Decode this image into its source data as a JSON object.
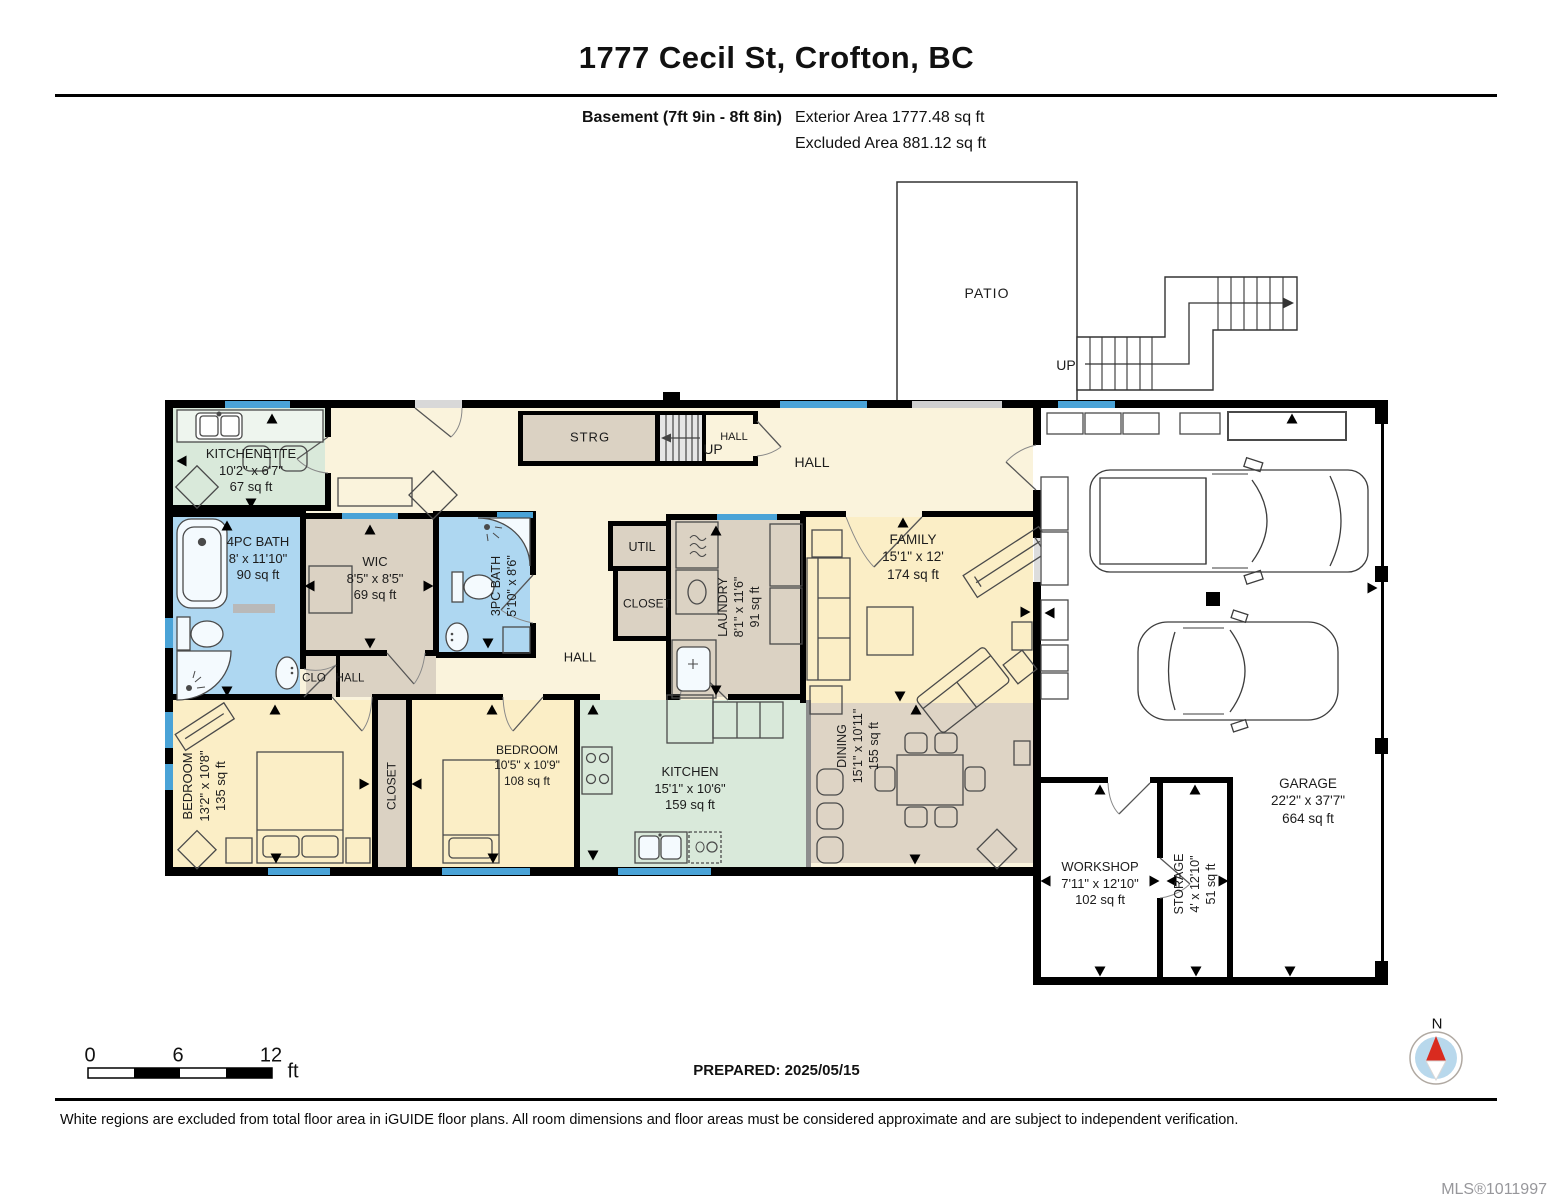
{
  "header": {
    "title": "1777 Cecil St, Crofton, BC",
    "floor_label": "Basement (7ft 9in - 8ft 8in)",
    "exterior_area": "Exterior Area 1777.48 sq ft",
    "excluded_area": "Excluded Area 881.12 sq ft"
  },
  "rooms": {
    "patio": {
      "name": "PATIO"
    },
    "exterior_stairs": {
      "direction": "UP"
    },
    "interior_stairs": {
      "direction": "UP"
    },
    "strg": {
      "name": "STRG"
    },
    "hall_by_stairs": {
      "name": "HALL"
    },
    "hall_top": {
      "name": "HALL"
    },
    "hall_mid": {
      "name": "HALL"
    },
    "clo": {
      "name": "CLO"
    },
    "hall_lower": {
      "name": "HALL"
    },
    "kitchenette": {
      "name": "KITCHENETTE",
      "dims": "10'2\" x 6'7\"",
      "area": "67 sq ft"
    },
    "bath_4pc": {
      "name": "4PC BATH",
      "dims": "8' x 11'10\"",
      "area": "90 sq ft"
    },
    "wic": {
      "name": "WIC",
      "dims": "8'5\" x 8'5\"",
      "area": "69 sq ft"
    },
    "bath_3pc": {
      "name": "3PC BATH",
      "dims": "5'10\" x 8'6\""
    },
    "util": {
      "name": "UTIL"
    },
    "closet_mid": {
      "name": "CLOSET"
    },
    "laundry": {
      "name": "LAUNDRY",
      "dims": "8'1\" x 11'6\"",
      "area": "91 sq ft"
    },
    "family": {
      "name": "FAMILY",
      "dims": "15'1\" x 12'",
      "area": "174 sq ft"
    },
    "bedroom_left": {
      "name": "BEDROOM",
      "dims": "13'2\" x 10'8\"",
      "area": "135 sq ft"
    },
    "closet_bottom": {
      "name": "CLOSET"
    },
    "bedroom_right": {
      "name": "BEDROOM",
      "dims": "10'5\" x 10'9\"",
      "area": "108 sq ft"
    },
    "kitchen": {
      "name": "KITCHEN",
      "dims": "15'1\" x 10'6\"",
      "area": "159 sq ft"
    },
    "dining": {
      "name": "DINING",
      "dims": "15'1\" x 10'11\"",
      "area": "155 sq ft"
    },
    "workshop": {
      "name": "WORKSHOP",
      "dims": "7'11\" x 12'10\"",
      "area": "102 sq ft"
    },
    "storage": {
      "name": "STORAGE",
      "dims": "4' x 12'10\"",
      "area": "51 sq ft"
    },
    "garage": {
      "name": "GARAGE",
      "dims": "22'2\" x 37'7\"",
      "area": "664 sq ft"
    }
  },
  "scale_bar": {
    "ticks": [
      "0",
      "6",
      "12"
    ],
    "unit": "ft"
  },
  "compass": {
    "label": "N"
  },
  "footer": {
    "prepared": "PREPARED: 2025/05/15",
    "disclaimer": "White regions are excluded from total floor area in iGUIDE floor plans. All room dimensions and floor areas must be considered approximate and are subject to independent verification.",
    "mls": "MLS®1011997"
  },
  "colors": {
    "hall": "#faf3dc",
    "bedroom": "#fbeec6",
    "kitchen": "#d9e9da",
    "bath": "#aed7f1",
    "closet_tan": "#dbd2c3",
    "dining": "#ded4c5",
    "window_blue": "#4aa3d7",
    "wall": "#000000",
    "compass_blue": "#b8d8ec",
    "compass_red": "#d92b1f"
  }
}
